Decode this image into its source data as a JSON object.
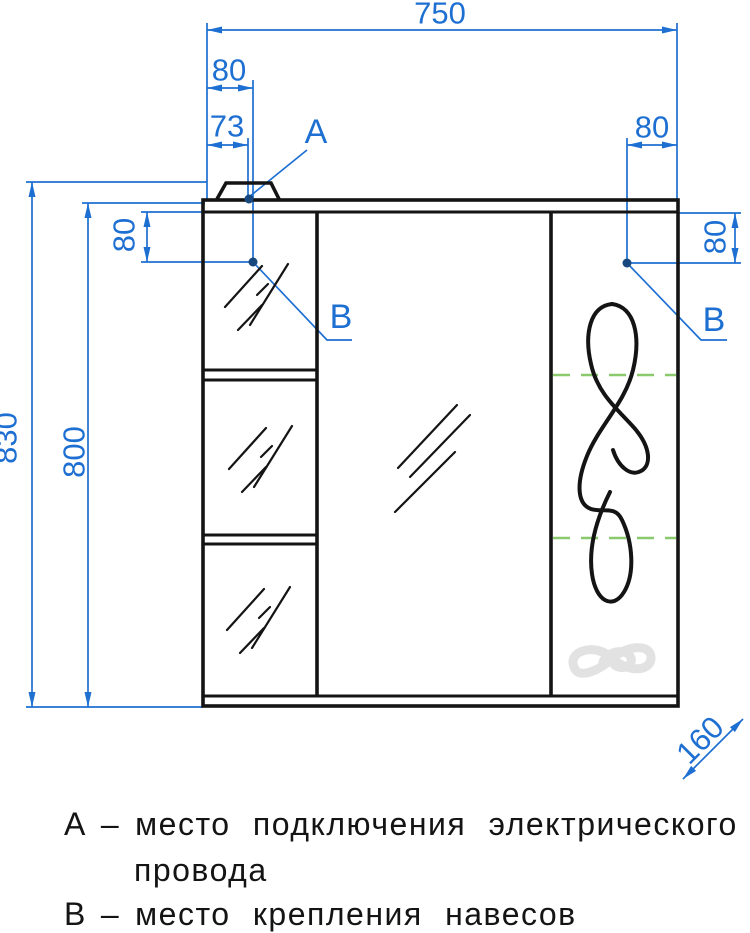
{
  "colors": {
    "dimension_blue": "#1e6fd2",
    "marker_navy": "#17497f",
    "line_black": "#141414",
    "shelf_green": "#8bc96d",
    "logo_gray": "#e2e2e2",
    "background": "#ffffff"
  },
  "dimensions": {
    "overall_width": "750",
    "hinge_offset_top_left": "80",
    "power_offset_top_left": "73",
    "hinge_offset_top_right": "80",
    "overall_height": "830",
    "body_height": "800",
    "hinge_drop_left": "80",
    "hinge_drop_right": "80",
    "depth": "160"
  },
  "point_labels": {
    "power_point": "A",
    "hinge_point_left": "B",
    "hinge_point_right": "B"
  },
  "legend": {
    "items": [
      {
        "key": "А",
        "separator": "–",
        "line1": "место подключения электрического",
        "line2": "провода"
      },
      {
        "key": "В",
        "separator": "–",
        "line1": "место крепления навесов",
        "line2": ""
      }
    ]
  }
}
